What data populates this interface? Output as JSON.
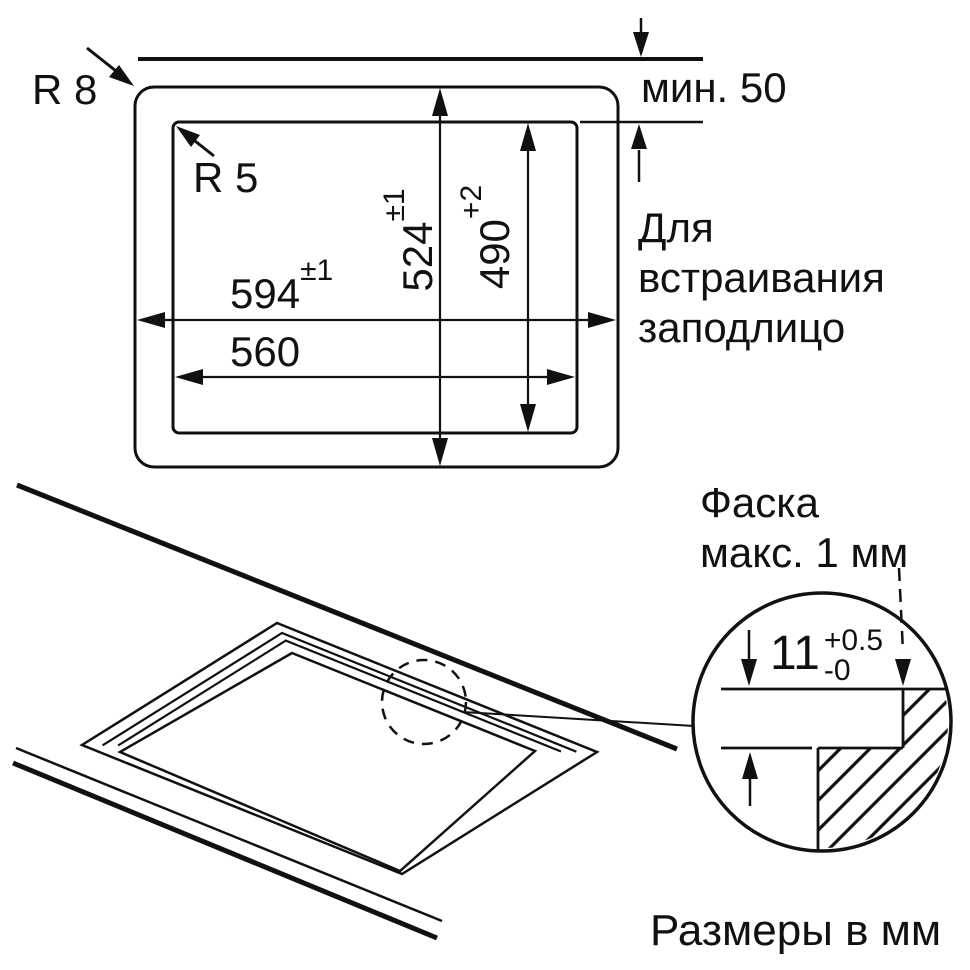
{
  "drawing": {
    "top_view": {
      "outer_radius_label": "R 8",
      "inner_radius_label": "R 5",
      "min_clearance_label": "мин. 50",
      "flush_note": {
        "line1": "Для",
        "line2": "встраивания",
        "line3": "заподлицо"
      },
      "dim_outer_width": {
        "value": "594",
        "tol": "±1"
      },
      "dim_inner_width": {
        "value": "560",
        "tol": ""
      },
      "dim_outer_depth": {
        "value": "524",
        "tol": "±1"
      },
      "dim_inner_depth": {
        "value": "490",
        "tol": "+2"
      }
    },
    "detail_view": {
      "chamfer_note": {
        "line1": "Фаска",
        "line2": "макс. 1 мм"
      },
      "recess_depth": {
        "value": "11",
        "tol_plus": "+0.5",
        "tol_minus": "-0"
      }
    },
    "units_note": "Размеры в мм"
  },
  "colors": {
    "ink": "#111111",
    "background": "#ffffff"
  }
}
